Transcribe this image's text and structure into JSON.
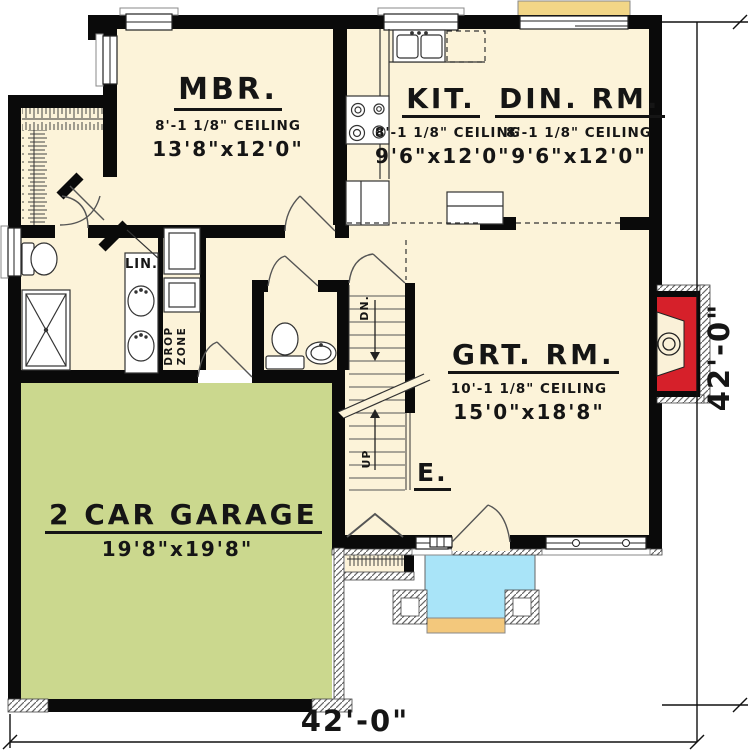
{
  "plan_type": "first-floor-plan",
  "rooms": {
    "mbr": {
      "name": "MBR.",
      "ceiling": "8'-1 1/8\" CEILING",
      "size": "13'8\"x12'0\""
    },
    "kit": {
      "name": "KIT.",
      "ceiling": "8'-1 1/8\" CEILING",
      "size": "9'6\"x12'0\""
    },
    "din": {
      "name": "DIN. RM.",
      "ceiling": "8'-1 1/8\" CEILING",
      "size": "9'6\"x12'0\""
    },
    "grt": {
      "name": "GRT. RM.",
      "ceiling": "10'-1 1/8\" CEILING",
      "size": "15'0\"x18'8\""
    },
    "garage": {
      "name": "2 CAR GARAGE",
      "size": "19'8\"x19'8\""
    },
    "linen": {
      "name": "LIN."
    },
    "drop_zone": {
      "line1": "DROP",
      "line2": "ZONE"
    },
    "entry": {
      "name": "E."
    }
  },
  "stairs": {
    "down": "DN.",
    "up": "UP"
  },
  "dimensions": {
    "bottom": "42'-0\"",
    "right": "42'-0\""
  },
  "colors": {
    "floor": "#fcf3d9",
    "wall": "#0a0a0a",
    "garage_floor": "#cbd88e",
    "porch": "#a9e4f8",
    "deck": "#f2d687",
    "step": "#f3c87c",
    "fireplace": "#d6202a",
    "ink": "#151515"
  }
}
